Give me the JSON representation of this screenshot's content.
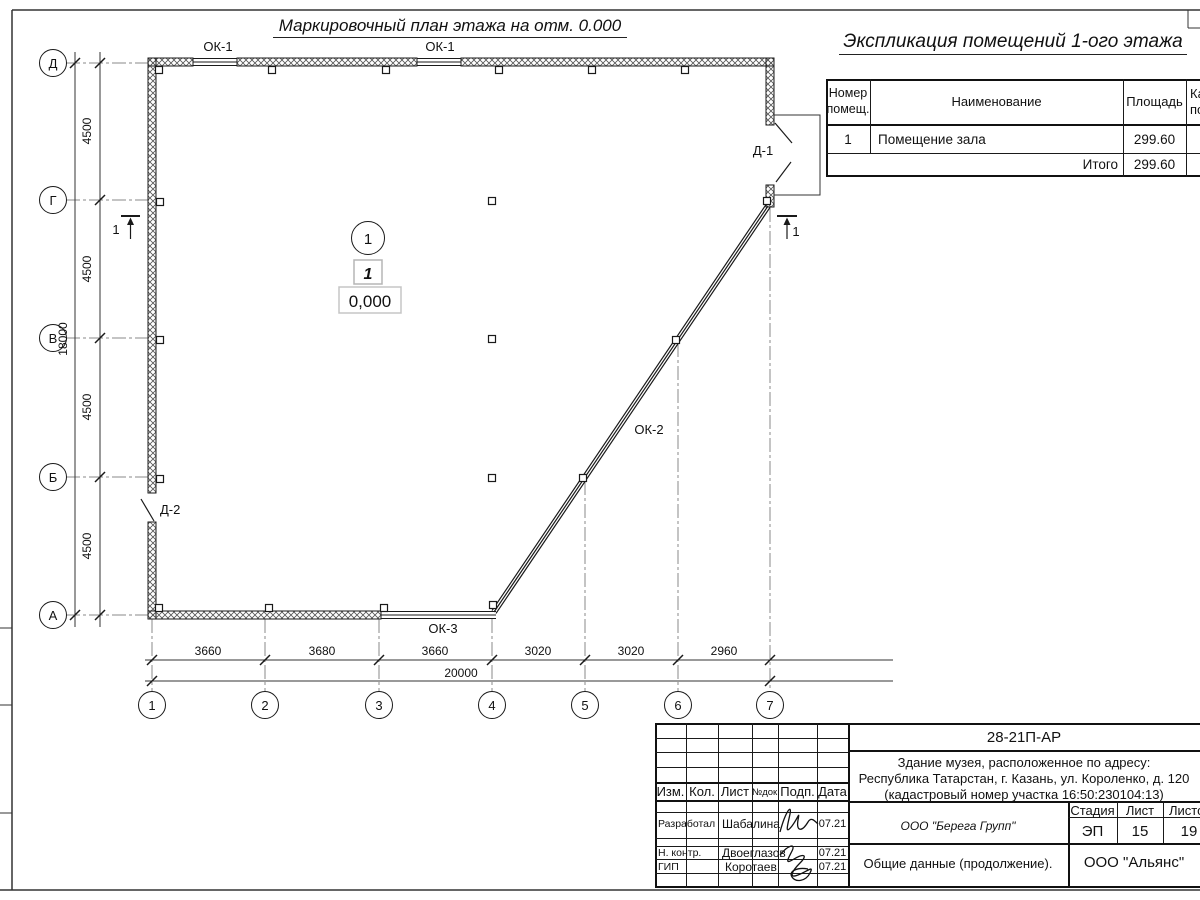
{
  "plan": {
    "title": "Маркировочный план этажа на отм. 0.000",
    "axes_rows": [
      "Д",
      "Г",
      "В",
      "Б",
      "А"
    ],
    "axes_cols": [
      "1",
      "2",
      "3",
      "4",
      "5",
      "6",
      "7"
    ],
    "dims_left": [
      "4500",
      "4500",
      "4500",
      "4500"
    ],
    "dim_left_total": "18000",
    "dims_bottom": [
      "3660",
      "3680",
      "3660",
      "3020",
      "3020",
      "2960"
    ],
    "dim_bottom_total": "20000",
    "labels": {
      "ok1_a": "ОК-1",
      "ok1_b": "ОК-1",
      "ok2": "ОК-2",
      "ok3": "ОК-3",
      "d1": "Д-1",
      "d2": "Д-2",
      "room_number": "1",
      "room_tag": "1",
      "level": "0,000",
      "section_left": "1",
      "section_right": "1"
    }
  },
  "explication": {
    "title": "Экспликация помещений 1-ого этажа",
    "headers": {
      "number_l1": "Номер",
      "number_l2": "помещ.",
      "name": "Наименование",
      "area": "Площадь",
      "cat_l1": "Ка",
      "cat_l2": "по"
    },
    "rows": [
      {
        "number": "1",
        "name": "Помещение зала",
        "area": "299.60"
      }
    ],
    "total_label": "Итого",
    "total_area": "299.60"
  },
  "titleblock": {
    "doc_number": "28-21П-АР",
    "project_line1": "Здание музея, расположенное по адресу:",
    "project_line2": "Республика Татарстан, г. Казань, ул. Короленко, д. 120",
    "project_line3": "(кадастровый номер участка 16:50:230104:13)",
    "header_cells": [
      "Изм.",
      "Кол.",
      "Лист",
      "№док.",
      "Подп.",
      "Дата"
    ],
    "roles": [
      {
        "role": "Разработал",
        "name": "Шабалина",
        "date": "07.21"
      },
      {
        "role": "Н. контр.",
        "name": "Двоеглазов",
        "date": "07.21"
      },
      {
        "role": "ГИП",
        "name": "Коротаев",
        "date": "07.21"
      }
    ],
    "org_italic": "ООО \"Берега Групп\"",
    "stage_label": "Стадия",
    "sheet_label": "Лист",
    "sheets_label": "Листов",
    "stage": "ЭП",
    "sheet": "15",
    "sheets": "19",
    "doc_title": "Общие данные (продолжение).",
    "org2": "ООО \"Альянс\""
  }
}
